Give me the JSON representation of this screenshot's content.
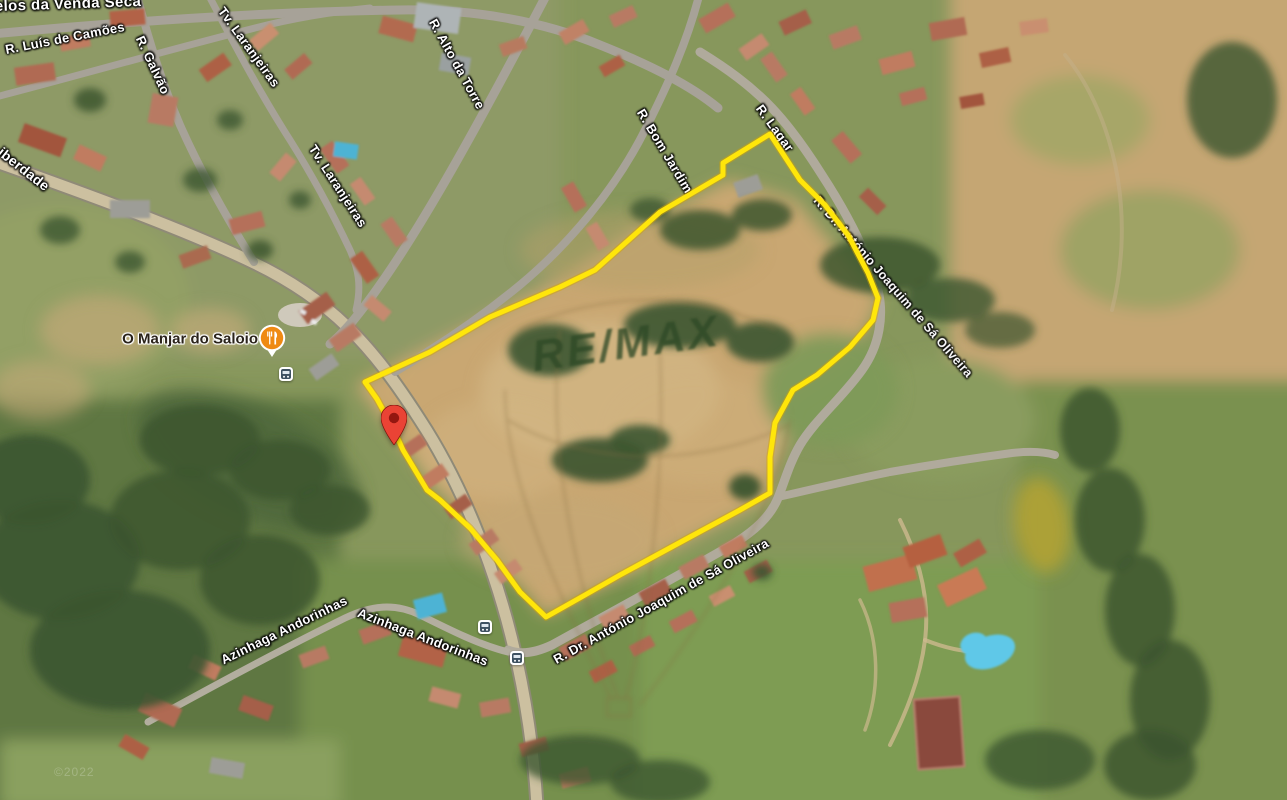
{
  "map": {
    "type": "satellite-view",
    "attribution_partial": "©2022",
    "field_vegetation_text": "RE/MAX",
    "colors": {
      "parcel_outline": "#FFE60A",
      "pin": "#EA4335",
      "poi_restaurant": "#EF8A13",
      "bus_badge": "#3E5161"
    }
  },
  "labels": {
    "locality_partial": "elos da Venda Seca",
    "streets": [
      {
        "name": "R. Luís de Camões"
      },
      {
        "name": "R. Galvão"
      },
      {
        "name": "Tv. Laranjeiras"
      },
      {
        "name": "iberdade"
      },
      {
        "name": "Tv. Laranjeiras"
      },
      {
        "name": "R. Alto da Torre"
      },
      {
        "name": "R. Bom Jardim"
      },
      {
        "name": "R. Lagar"
      },
      {
        "name": "R. Dr. António Joaquim de Sá Oliveira"
      },
      {
        "name": "R. Dr. António Joaquim de Sá Oliveira"
      },
      {
        "name": "Azinhaga Andorinhas"
      },
      {
        "name": "Azinhaga Andorinhas"
      }
    ]
  },
  "poi": {
    "name": "O Manjar do Saloio",
    "category": "restaurant"
  },
  "transit": {
    "stop_count": 3
  }
}
